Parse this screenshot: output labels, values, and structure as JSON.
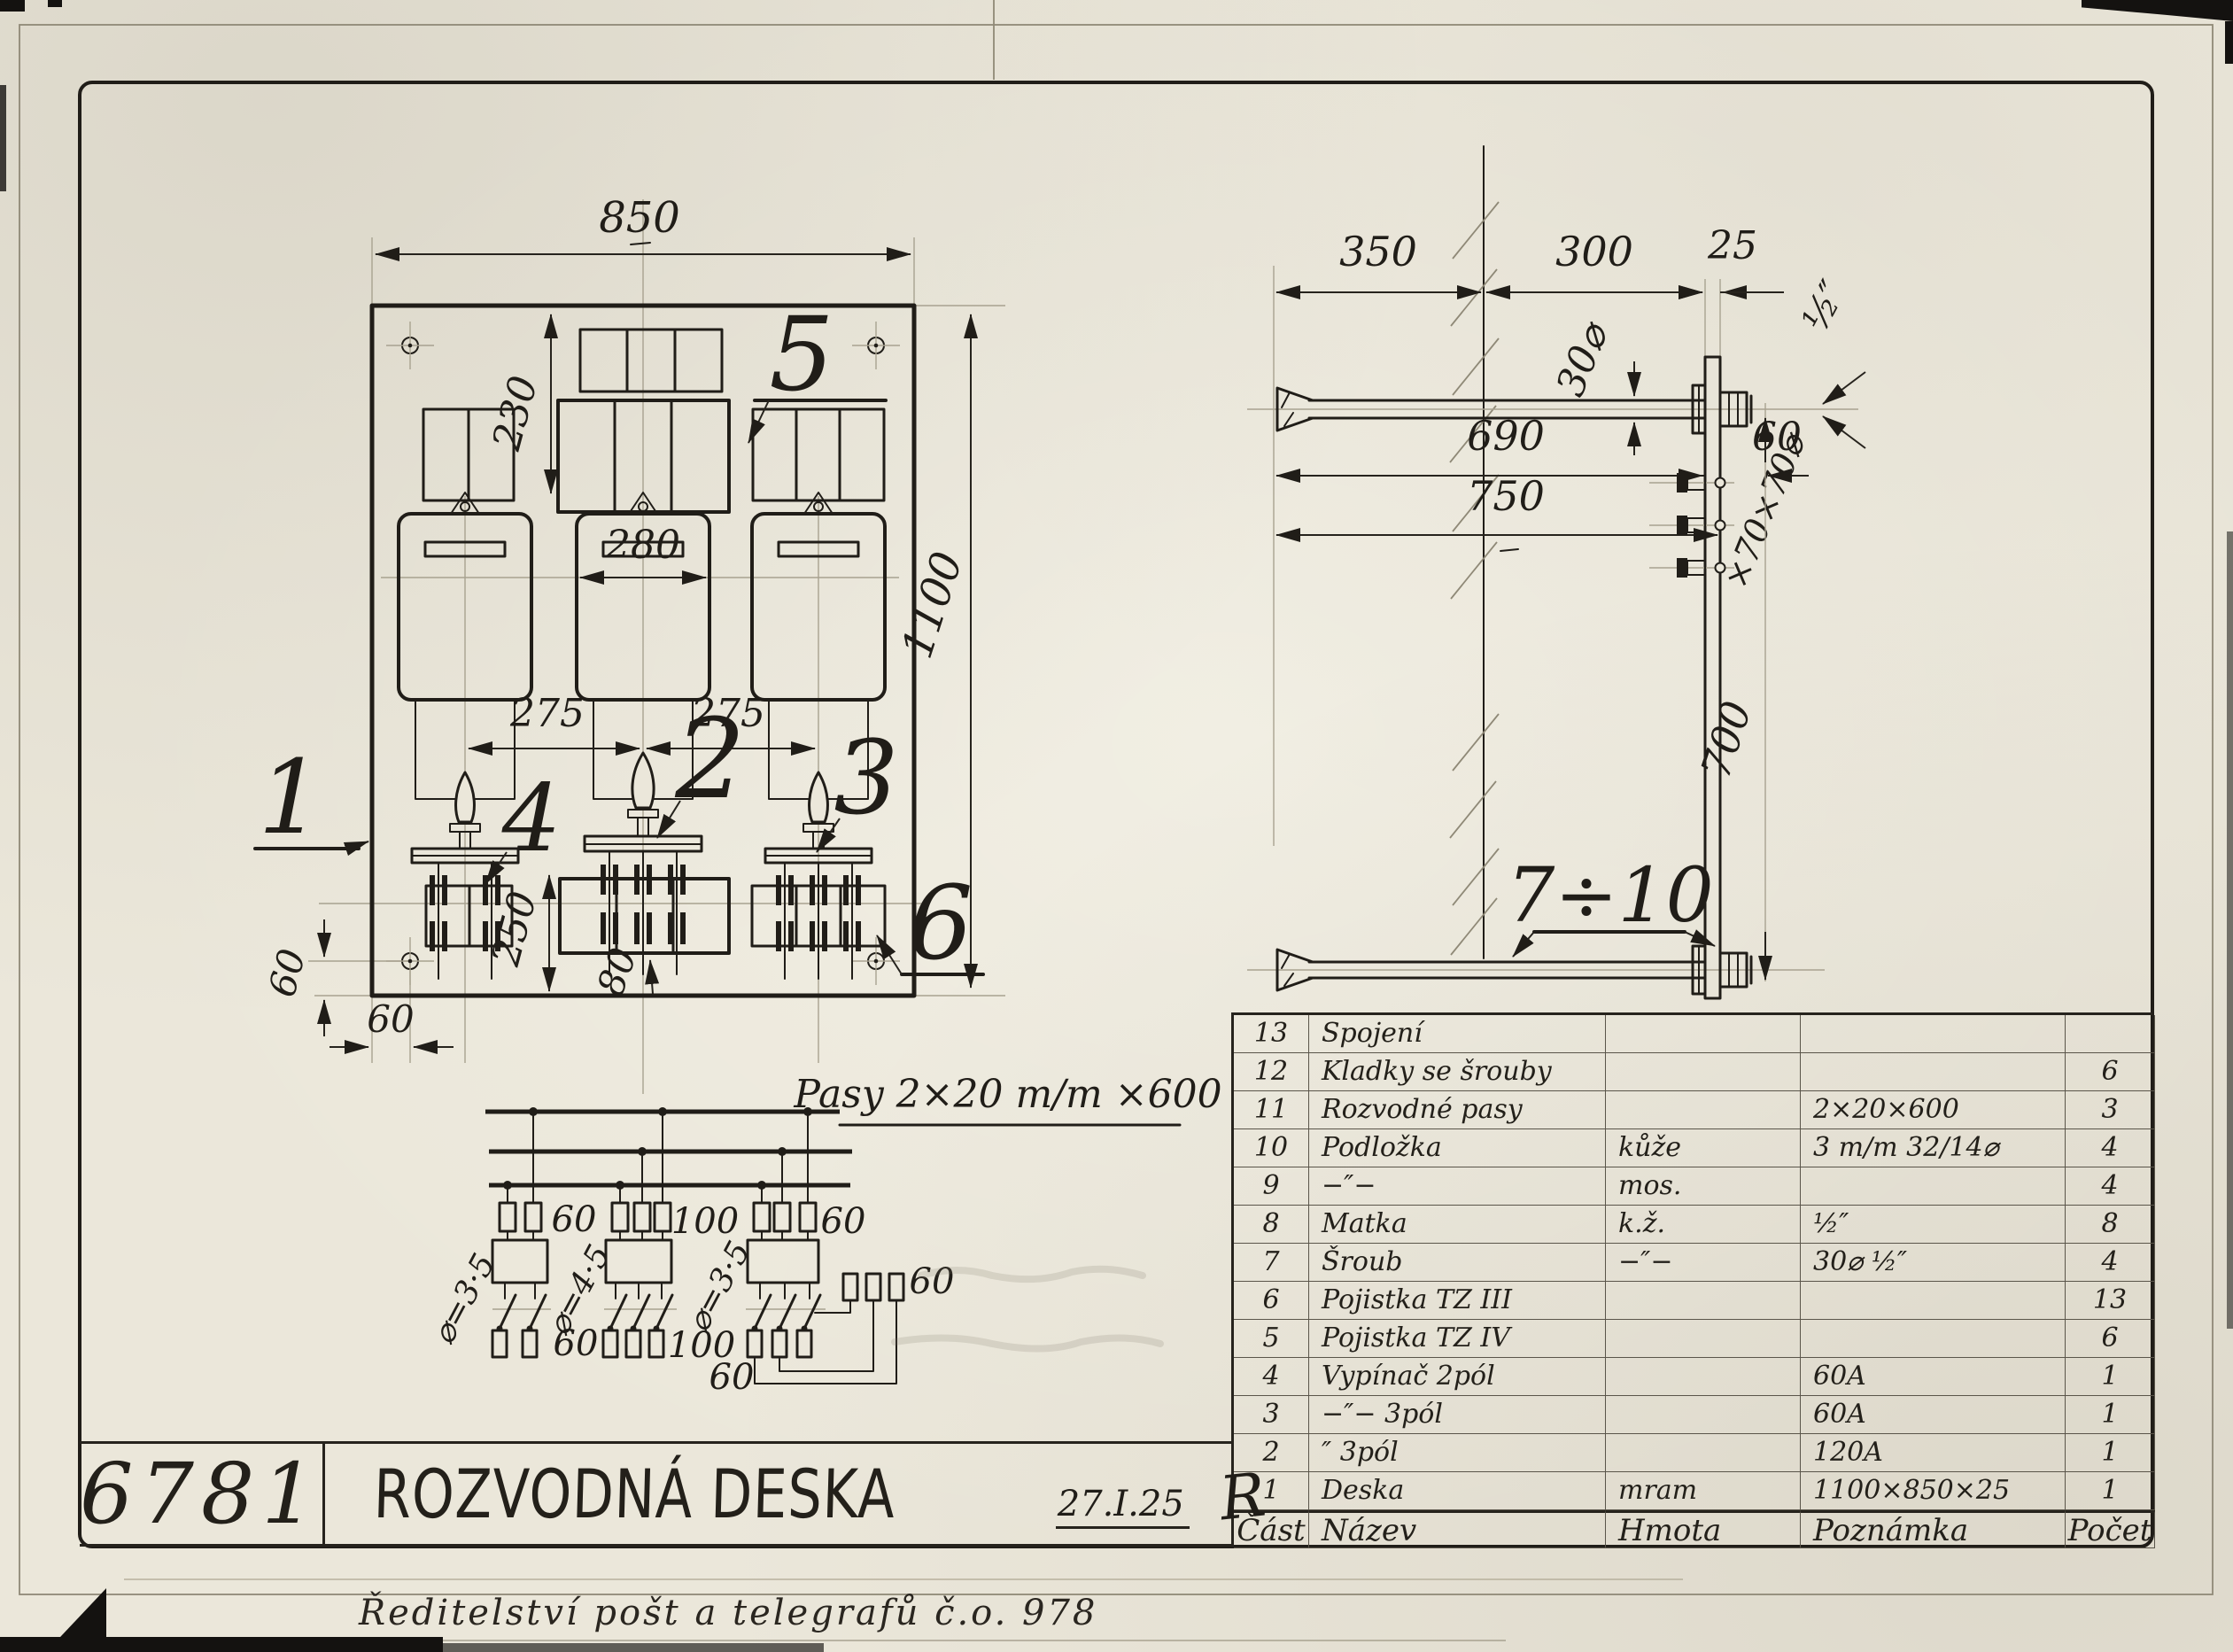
{
  "sheet": {
    "number": "6781",
    "title": "ROZVODNÁ DESKA",
    "date": "27.I.25",
    "signature": "R",
    "footer": "Ředitelství pošt a telegrafů č.o. 978"
  },
  "front_view": {
    "labels": {
      "l1": "1",
      "l2": "2",
      "l3": "3",
      "l4": "4",
      "l5": "5",
      "l6": "6"
    },
    "dims": {
      "width": "850",
      "offset_top": "230",
      "meter_width": "280",
      "spacing_a": "275",
      "spacing_b": "275",
      "height": "1100",
      "row_bottom": "250",
      "fuse_offset": "80",
      "screw_v": "60",
      "screw_h": "60"
    }
  },
  "side_view": {
    "label": "7÷10",
    "dims": {
      "seg_350": "350",
      "seg_300": "300",
      "seg_25": "25",
      "bolt_dia": "30⌀",
      "thread": "½″",
      "len_690": "690",
      "len_60": "60",
      "len_750": "750",
      "len_700": "700",
      "pad_note": "×70×70⌀"
    }
  },
  "schematic": {
    "title": "Pasy 2×20 m/m ×600",
    "upper": [
      "60",
      "100",
      "60"
    ],
    "lower": [
      "60",
      "100",
      "60"
    ],
    "extra": "60",
    "dia": [
      "⌀=3·5",
      "⌀=4·5",
      "⌀=3·5"
    ]
  },
  "parts_table": {
    "headers": {
      "part": "Část",
      "name": "Název",
      "material": "Hmota",
      "note": "Poznámka",
      "count": "Počet"
    },
    "rows": [
      {
        "part": "13",
        "name": "Spojení",
        "material": "",
        "note": "",
        "count": ""
      },
      {
        "part": "12",
        "name": "Kladky se šrouby",
        "material": "",
        "note": "",
        "count": "6"
      },
      {
        "part": "11",
        "name": "Rozvodné pasy",
        "material": "",
        "note": "2×20×600",
        "count": "3"
      },
      {
        "part": "10",
        "name": "Podložka",
        "material": "kůže",
        "note": "3 m/m 32/14⌀",
        "count": "4"
      },
      {
        "part": "9",
        "name": "−″−",
        "material": "mos.",
        "note": "",
        "count": "4"
      },
      {
        "part": "8",
        "name": "Matka",
        "material": "k.ž.",
        "note": "½″",
        "count": "8"
      },
      {
        "part": "7",
        "name": "Šroub",
        "material": "−″−",
        "note": "30⌀  ½″",
        "count": "4"
      },
      {
        "part": "6",
        "name": "Pojistka TZ III",
        "material": "",
        "note": "",
        "count": "13"
      },
      {
        "part": "5",
        "name": "Pojistka TZ IV",
        "material": "",
        "note": "",
        "count": "6"
      },
      {
        "part": "4",
        "name": "Vypínač 2pól",
        "material": "",
        "note": "60A",
        "count": "1"
      },
      {
        "part": "3",
        "name": "−″−   3pól",
        "material": "",
        "note": "60A",
        "count": "1"
      },
      {
        "part": "2",
        "name": "″   3pól",
        "material": "",
        "note": "120A",
        "count": "1"
      },
      {
        "part": "1",
        "name": "Deska",
        "material": "mram",
        "note": "1100×850×25",
        "count": "1"
      }
    ]
  }
}
